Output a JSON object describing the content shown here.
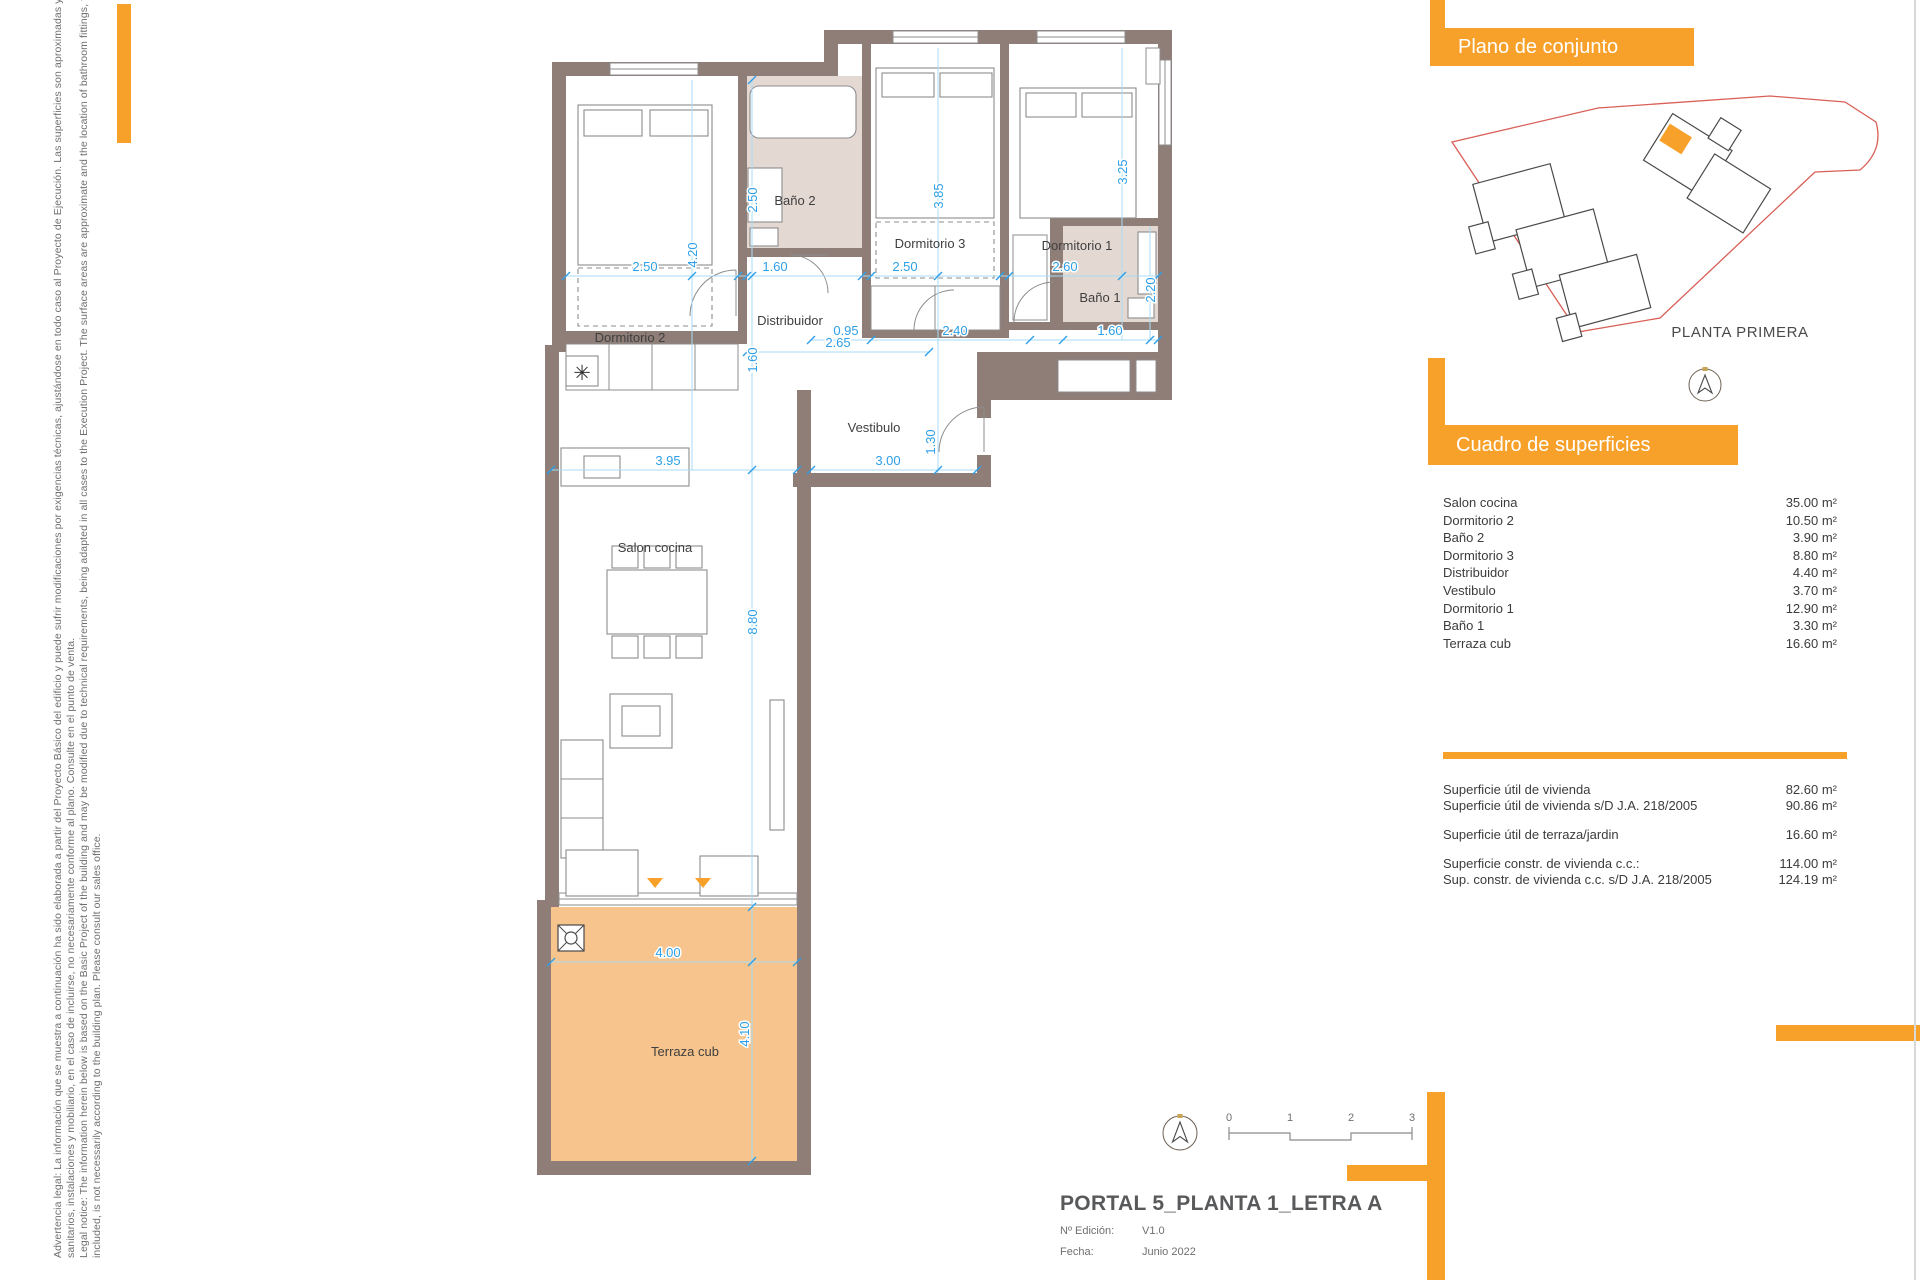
{
  "accent_color": "#F7A12B",
  "wall_color": "#8F7D78",
  "terrace_color": "#F6C48C",
  "dimension_color": "#2D9FE8",
  "legal": {
    "lines": [
      "Advertencia legal: La información que se muestra a continuación ha sido elaborada a partir del Proyecto Básico del edificio y puede sufrir modificaciones por exigencias técnicas, ajustándose en todo caso al Proyecto de Ejecución. Las superficies son aproximadas y la ubicación de aparatos",
      "sanitarios, instalaciones y mobiliario, en el caso de incluirse, no necesariamente conforme al plano. Consulte en el punto de venta.",
      "Legal notice: The information herein below is based on the Basic Project of the building and may be modified due to technical requirements, being adapted in all cases to the Execution Project. The surface areas are approximate and the location of bathroom fittings, facilities and furniture, if",
      "included, is not necessarily according to the building plan. Please consult our sales office."
    ]
  },
  "site": {
    "title": "Plano de conjunto",
    "caption": "PLANTA PRIMERA"
  },
  "surfaces": {
    "title": "Cuadro de superficies",
    "rows": [
      {
        "label": "Salon cocina",
        "value": "35.00 m²"
      },
      {
        "label": "Dormitorio 2",
        "value": "10.50 m²"
      },
      {
        "label": "Baño 2",
        "value": "3.90 m²"
      },
      {
        "label": "Dormitorio 3",
        "value": "8.80 m²"
      },
      {
        "label": "Distribuidor",
        "value": "4.40 m²"
      },
      {
        "label": "Vestibulo",
        "value": "3.70 m²"
      },
      {
        "label": "Dormitorio 1",
        "value": "12.90 m²"
      },
      {
        "label": "Baño 1",
        "value": "3.30 m²"
      },
      {
        "label": "Terraza cub",
        "value": "16.60 m²"
      }
    ]
  },
  "summary": {
    "rows": [
      {
        "label": "Superficie útil de vivienda",
        "value": "82.60 m²"
      },
      {
        "label": "Superficie útil de vivienda s/D J.A. 218/2005",
        "value": "90.86 m²"
      },
      {
        "label": "Superficie útil de terraza/jardin",
        "value": "16.60 m²"
      },
      {
        "label": "Superficie constr. de vivienda c.c.:",
        "value": "114.00 m²"
      },
      {
        "label": "Sup. constr. de vivienda c.c. s/D J.A. 218/2005",
        "value": "124.19 m²"
      }
    ]
  },
  "titleblock": {
    "title": "PORTAL 5_PLANTA 1_LETRA A",
    "edition_label": "Nº Edición:",
    "edition_value": "V1.0",
    "date_label": "Fecha:",
    "date_value": "Junio 2022"
  },
  "scalebar": {
    "ticks": [
      "0",
      "1",
      "2",
      "3"
    ]
  },
  "plan": {
    "rooms": {
      "dormitorio2": "Dormitorio 2",
      "bano2": "Baño 2",
      "dormitorio3": "Dormitorio 3",
      "dormitorio1": "Dormitorio 1",
      "distribuidor": "Distribuidor",
      "bano1": "Baño 1",
      "vestibulo": "Vestibulo",
      "salon": "Salon cocina",
      "terraza": "Terraza cub"
    },
    "dims": {
      "d2_w": "2.50",
      "d2_h": "4.20",
      "b2_w": "1.60",
      "b2_h": "2.50",
      "d3_w": "2.50",
      "d3_h": "3.85",
      "d1_w": "2.60",
      "d1_h": "3.25",
      "dis_w": "2.65",
      "dis_h": "1.60",
      "hall_a": "0.95",
      "hall_b": "2.40",
      "b1_w": "1.60",
      "b1_h": "2.20",
      "salon_w": "3.95",
      "vest_w": "3.00",
      "vest_h": "1.30",
      "salon_h": "8.80",
      "terr_w": "4.00",
      "terr_h": "4.10"
    },
    "heater_glyph": "✳"
  }
}
